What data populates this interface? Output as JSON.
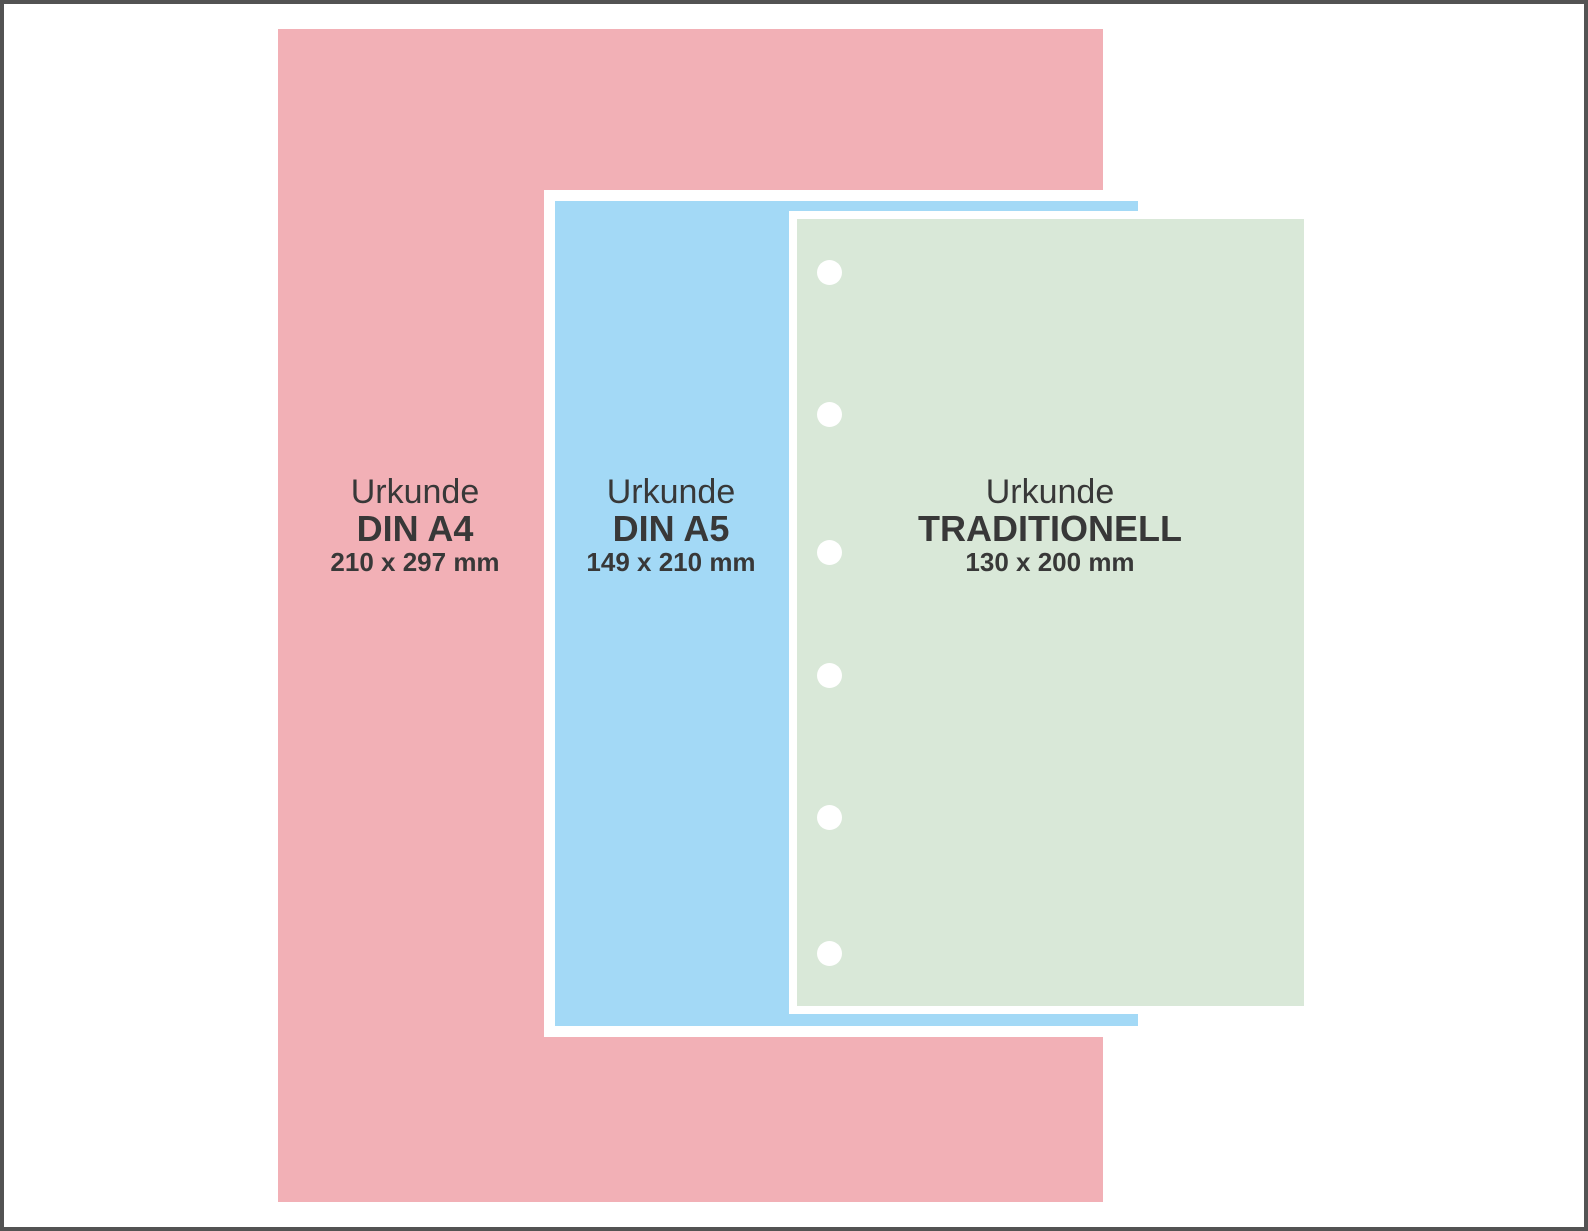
{
  "diagram": {
    "type": "paper-size-comparison",
    "background_color": "#ffffff",
    "frame_border_color": "#535353",
    "outline_color": "#ffffff",
    "text_color": "#383838"
  },
  "sheets": [
    {
      "id": "din-a4",
      "line1": "Urkunde",
      "line2": "DIN A4",
      "line3": "210 x 297 mm",
      "width_mm": 210,
      "height_mm": 297,
      "fill_color": "#f2b0b6",
      "punch_holes": 0
    },
    {
      "id": "din-a5",
      "line1": "Urkunde",
      "line2": "DIN A5",
      "line3": "149 x 210 mm",
      "width_mm": 149,
      "height_mm": 210,
      "fill_color": "#a3d9f6",
      "punch_holes": 0
    },
    {
      "id": "traditionell",
      "line1": "Urkunde",
      "line2": "TRADITIONELL",
      "line3": "130 x 200 mm",
      "width_mm": 130,
      "height_mm": 200,
      "fill_color": "#d9e8d8",
      "punch_holes": 6
    }
  ]
}
